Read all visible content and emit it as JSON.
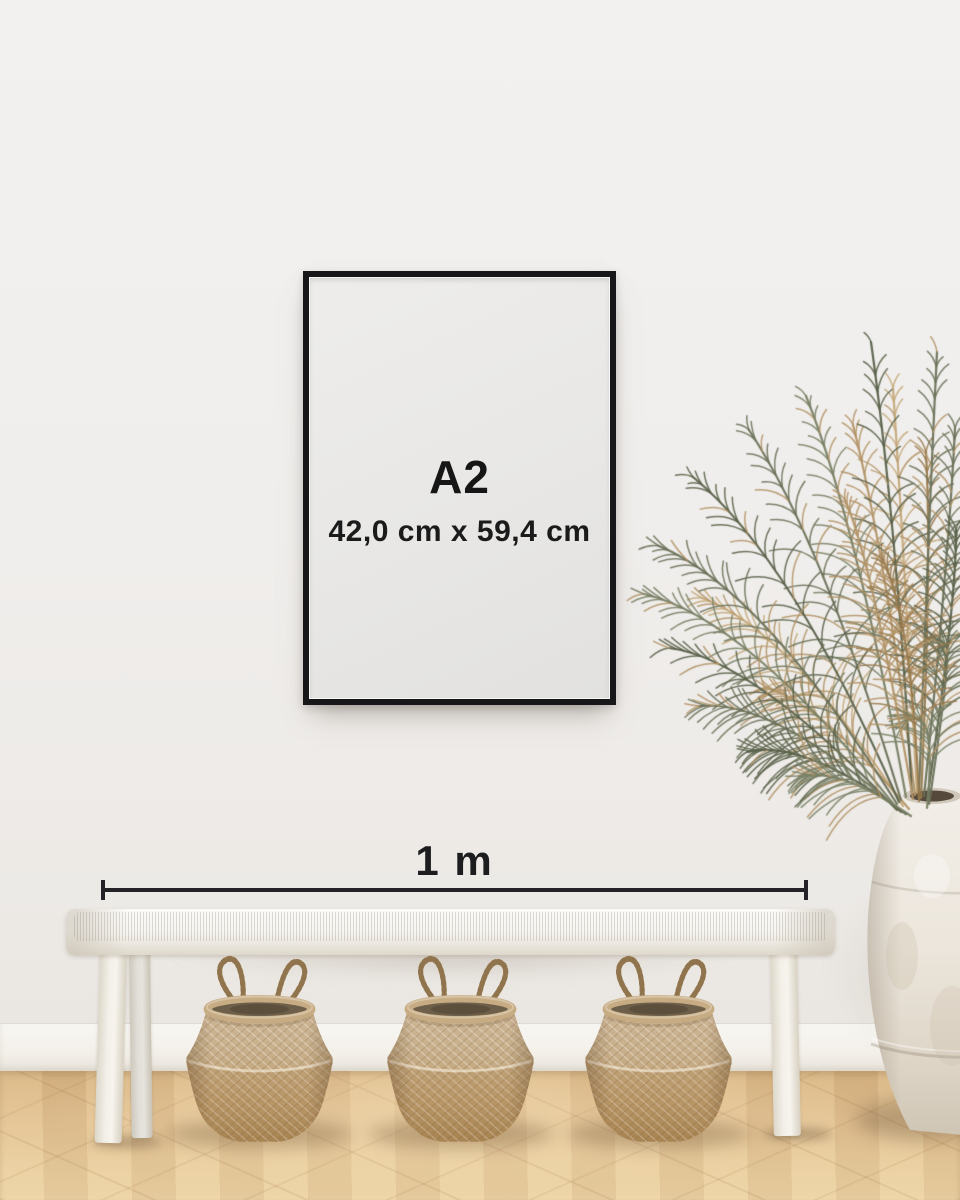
{
  "poster": {
    "size_label": "A2",
    "dimensions_label": "42,0 cm x 59,4 cm"
  },
  "measurement": {
    "label": "1 m"
  },
  "counts": {
    "baskets": 3
  },
  "colors": {
    "frame_black": "#17171a",
    "poster_bg": "#e9e7e5",
    "ink": "#161616",
    "wall": "#f1efed",
    "baseboard": "#f6f4f0",
    "floor_oak": "#e2c294",
    "bench_white": "#f5f3ef",
    "basket_tan": "#c3a87e",
    "basket_interior": "#6e5f4a",
    "vase_white": "#ece6dc",
    "plant_green_1": "#6a7158",
    "plant_green_2": "#596149",
    "plant_green_3": "#788064",
    "plant_tan_1": "#b29367",
    "plant_tan_2": "#c4a87a",
    "plant_tan_3": "#97794c"
  }
}
